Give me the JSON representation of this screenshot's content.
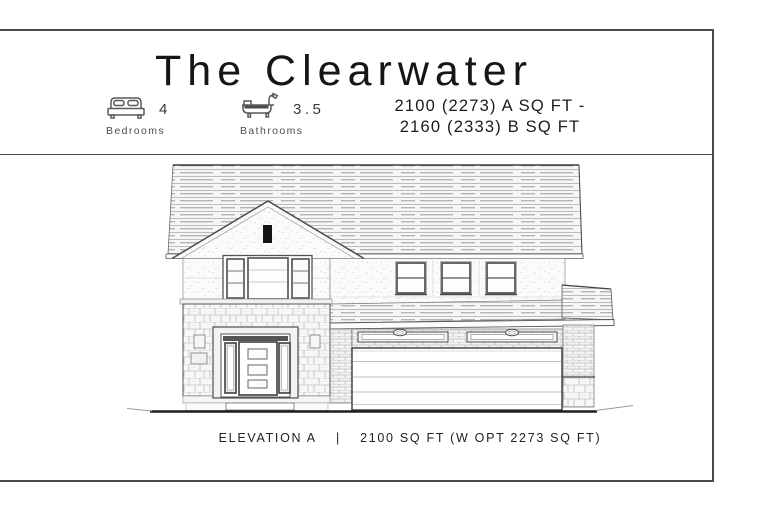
{
  "page": {
    "background": "#ffffff",
    "border_color": "#4a4a4a"
  },
  "header": {
    "title": "The Clearwater",
    "features": [
      {
        "icon": "bed-icon",
        "value": "4",
        "label": "Bedrooms"
      },
      {
        "icon": "bathtub-icon",
        "value": "3.5",
        "label": "Bathrooms"
      }
    ],
    "area": {
      "line1": "2100 (2273) A SQ FT -",
      "line2": "2160 (2333) B SQ FT"
    }
  },
  "drawing": {
    "type": "house-front-elevation",
    "stories": "2",
    "elements": [
      "main-roof",
      "front-gable",
      "attic-vent",
      "triple-window",
      "three-upper-windows",
      "front-door-with-sidelights",
      "garage-door",
      "stone-facade",
      "brick-facade",
      "ground-line"
    ]
  },
  "footer": {
    "elevation": "ELEVATION A",
    "divider": "|",
    "area": "2100 SQ FT (W OPT 2273 SQ FT)"
  }
}
